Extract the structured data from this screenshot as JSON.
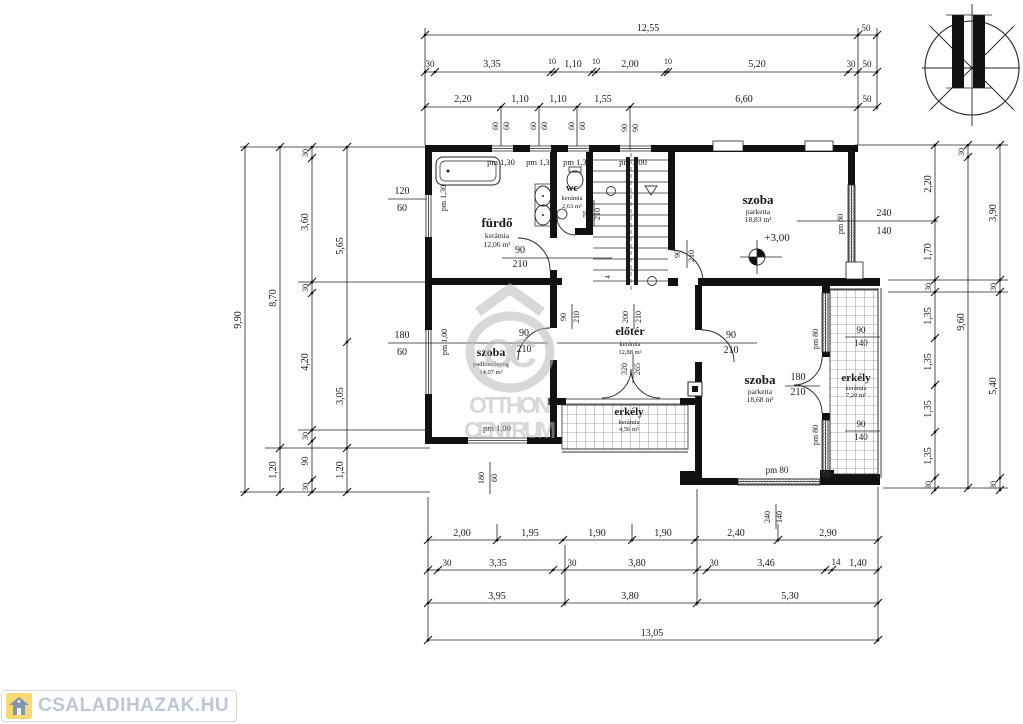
{
  "logo": {
    "text": "CSALADIHAZAK.HU"
  },
  "watermark": {
    "initials": "OC",
    "line1": "OTTHON",
    "line2": "CENTRUM"
  },
  "annotations": {
    "level": "+3,00",
    "stair_mark": "4"
  },
  "rooms": {
    "furdo": {
      "name": "fürdő",
      "material": "kerámia",
      "area": "12,06 m²"
    },
    "wc": {
      "name": "wc",
      "material": "kerámia",
      "area": "2,63 m²"
    },
    "szoba_top_right": {
      "name": "szoba",
      "material": "parketta",
      "area": "18,83 m²"
    },
    "szoba_left": {
      "name": "szoba",
      "material": "padlószőnyeg",
      "area": "14,07 m²"
    },
    "eloter": {
      "name": "előtér",
      "material": "kerámia",
      "area": "12,88 m²"
    },
    "szoba_bottom_right": {
      "name": "szoba",
      "material": "parketta",
      "area": "18,68 m²"
    },
    "erkely_middle": {
      "name": "erkély",
      "material": "kerámia",
      "area": "4,56 m²"
    },
    "erkely_right": {
      "name": "erkély",
      "material": "kerámia",
      "area": "7,20 m²"
    }
  },
  "openings": {
    "top_windows": {
      "pm1": "pm 1,30",
      "pm2": "pm 1,30",
      "pm3": "pm 1,30",
      "pm4": "pm 1,00"
    },
    "left_window_upper": {
      "w": "120",
      "h": "60",
      "pm": "pm 1,30"
    },
    "left_window_lower": {
      "w": "180",
      "h": "60",
      "pm": "pm 1,00"
    },
    "bottom_left_window": {
      "w": "180",
      "h": "60",
      "pm": "pm 1,00"
    },
    "bath_door": {
      "w": "90",
      "h": "210"
    },
    "wc_door": {
      "w": "75",
      "h": "210"
    },
    "corridor_door": {
      "w": "90",
      "h": "210"
    },
    "hall_opening": {
      "w": "200",
      "h": "210"
    },
    "szoba_tr_door": {
      "w": "90",
      "h": "210"
    },
    "szoba_left_door": {
      "w": "90",
      "h": "210"
    },
    "szoba_br_door": {
      "w": "90",
      "h": "210"
    },
    "terrace_opening": {
      "w": "320",
      "h": "265"
    },
    "erkely_door": {
      "w": "180",
      "h": "210"
    },
    "szoba_tr_window": {
      "w": "240",
      "h": "140",
      "pm": "pm 80"
    },
    "szoba_br_window": {
      "w": "240",
      "h": "140",
      "pm": "pm 80"
    },
    "erkely_window_top": {
      "w": "90",
      "h": "140",
      "pm": "pm 80"
    },
    "erkely_window_bottom": {
      "w": "90",
      "h": "140",
      "pm": "pm 80"
    }
  },
  "dims": {
    "top1": [
      "12,55",
      "50"
    ],
    "top2": [
      "30",
      "3,35",
      "10",
      "1,10",
      "10",
      "2,00",
      "10",
      "5,20",
      "30",
      "50"
    ],
    "top3": [
      "2,20",
      "1,10",
      "1,10",
      "1,55",
      "6,60",
      "50"
    ],
    "top4": [
      "60",
      "60",
      "60",
      "60",
      "60",
      "60",
      "90",
      "90"
    ],
    "left1": [
      "9,90"
    ],
    "left2": [
      "8,70",
      "1,20"
    ],
    "left3": [
      "30",
      "3,60",
      "30",
      "4,20",
      "30",
      "90",
      "30"
    ],
    "left4": [
      "5,65",
      "3,05",
      "1,20"
    ],
    "right1": [
      "2,20",
      "1,70",
      "30",
      "1,35",
      "1,35",
      "1,35",
      "1,35",
      "30"
    ],
    "right2": [
      "30",
      "9,60"
    ],
    "right3": [
      "3,90",
      "30",
      "5,40",
      "30"
    ],
    "bottom1": [
      "2,00",
      "1,95",
      "1,90",
      "1,90",
      "2,40",
      "2,90"
    ],
    "bottom2": [
      "30",
      "3,35",
      "30",
      "3,80",
      "30",
      "3,46",
      "14",
      "1,40"
    ],
    "bottom3": [
      "3,95",
      "3,80",
      "5,30"
    ],
    "bottom4": [
      "13,05"
    ]
  }
}
